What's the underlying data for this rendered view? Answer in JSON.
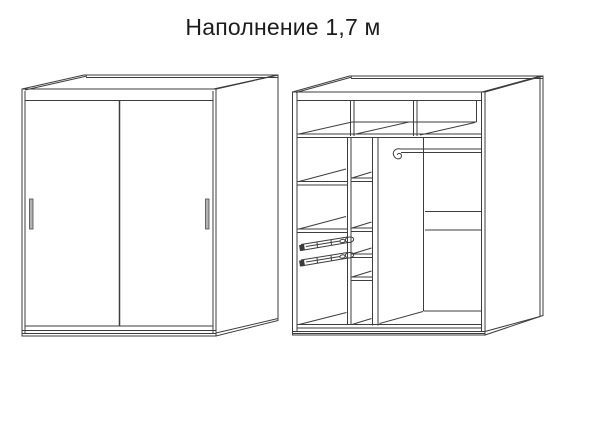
{
  "title": "Наполнение 1,7 м",
  "colors": {
    "background": "#ffffff",
    "line": "#3d3d3d",
    "handle_fill": "#b3b3b3",
    "handle_stroke": "#4a4a4a",
    "slide_cap": "#3a3a3a"
  },
  "figures": {
    "closed_wardrobe": "wardrobe-closed-sliding-doors-view",
    "open_wardrobe": "wardrobe-interior-fill-view"
  }
}
